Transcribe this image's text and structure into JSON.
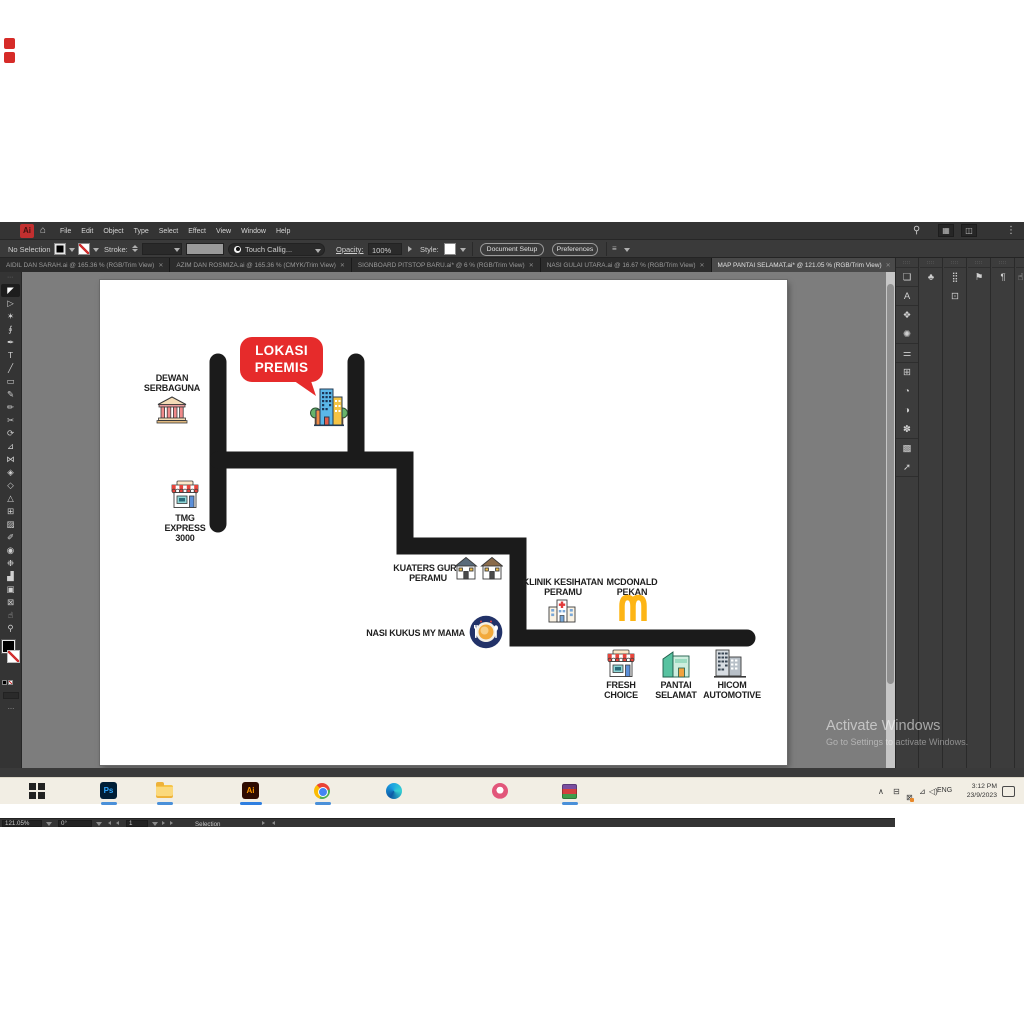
{
  "colors": {
    "accent_red": "#e62b2b",
    "road_black": "#1b1b1b",
    "pasteboard_gray": "#7d7d7d",
    "ui_dark": "#3a3a3a",
    "taskbar_beige": "#f2eee4",
    "taskbar_underline_blue": "#4a90d9",
    "mcdonald_yellow": "#fdb515"
  },
  "ui": {
    "close_glyph": "✕",
    "dock_grip": "∷∷",
    "tools_grip": "⋯",
    "ellipsis": "…"
  },
  "menubar": {
    "logo": "Ai",
    "home_icon": "⌂",
    "menus": [
      "File",
      "Edit",
      "Object",
      "Type",
      "Select",
      "Effect",
      "View",
      "Window",
      "Help"
    ],
    "right_icons": [
      {
        "name": "search",
        "glyph": "⚲"
      },
      {
        "name": "workspace-switcher",
        "glyph": "▦"
      },
      {
        "name": "arrange-documents",
        "glyph": "◫"
      },
      {
        "name": "more-options",
        "glyph": "⋮"
      }
    ]
  },
  "options_bar": {
    "no_selection": "No Selection",
    "stroke_label": "Stroke:",
    "brush_name": "Touch Callig...",
    "opacity_label": "Opacity:",
    "opacity_value": "100%",
    "style_label": "Style:",
    "document_setup": "Document Setup",
    "preferences": "Preferences",
    "align_glyph": "≡"
  },
  "tabs": [
    {
      "title": "AIDIL DAN SARAH.ai @ 165.36 % (RGB/Trim View)",
      "active": false
    },
    {
      "title": "AZIM DAN ROSMIZA.ai @ 165.36 % (CMYK/Trim View)",
      "active": false
    },
    {
      "title": "SIGNBOARD PITSTOP BARU.ai* @ 6 % (RGB/Trim View)",
      "active": false
    },
    {
      "title": "NASI GULAI UTARA.ai @ 16.67 % (RGB/Trim View)",
      "active": false
    },
    {
      "title": "MAP PANTAI SELAMAT.ai* @ 121.05 % (RGB/Trim View)",
      "active": true
    }
  ],
  "tools": [
    {
      "name": "selection",
      "glyph": "◤"
    },
    {
      "name": "direct-selection",
      "glyph": "▷"
    },
    {
      "name": "magic-wand",
      "glyph": "✶"
    },
    {
      "name": "lasso",
      "glyph": "∮"
    },
    {
      "name": "pen",
      "glyph": "✒"
    },
    {
      "name": "type",
      "glyph": "T"
    },
    {
      "name": "line-segment",
      "glyph": "╱"
    },
    {
      "name": "rectangle",
      "glyph": "▭"
    },
    {
      "name": "paintbrush",
      "glyph": "✎"
    },
    {
      "name": "pencil",
      "glyph": "✏"
    },
    {
      "name": "scissors",
      "glyph": "✂"
    },
    {
      "name": "rotate",
      "glyph": "⟳"
    },
    {
      "name": "scale",
      "glyph": "⊿"
    },
    {
      "name": "width",
      "glyph": "⋈"
    },
    {
      "name": "free-transform",
      "glyph": "◈"
    },
    {
      "name": "shape-builder",
      "glyph": "◇"
    },
    {
      "name": "perspective-grid",
      "glyph": "△"
    },
    {
      "name": "mesh",
      "glyph": "⊞"
    },
    {
      "name": "gradient",
      "glyph": "▨"
    },
    {
      "name": "eyedropper",
      "glyph": "✐"
    },
    {
      "name": "blend",
      "glyph": "◉"
    },
    {
      "name": "symbol-sprayer",
      "glyph": "❉"
    },
    {
      "name": "column-graph",
      "glyph": "▟"
    },
    {
      "name": "artboard",
      "glyph": "▣"
    },
    {
      "name": "slice",
      "glyph": "⊠"
    },
    {
      "name": "hand",
      "glyph": "☝"
    },
    {
      "name": "zoom",
      "glyph": "⚲"
    }
  ],
  "map": {
    "bubble": {
      "line1": "LOKASI",
      "line2": "PREMIS"
    },
    "dewan": {
      "line1": "DEWAN",
      "line2": "SERBAGUNA"
    },
    "tmg": {
      "line1": "TMG",
      "line2": "EXPRESS",
      "line3": "3000"
    },
    "kuaters": {
      "line1": "KUATERS GURU",
      "line2": "PERAMU"
    },
    "klinik": {
      "line1": "KLINIK KESIHATAN",
      "line2": "PERAMU"
    },
    "mcdonald": {
      "line1": "MCDONALD",
      "line2": "PEKAN"
    },
    "nasi": {
      "line1": "NASI KUKUS MY MAMA"
    },
    "fresh": {
      "line1": "FRESH",
      "line2": "CHOICE"
    },
    "pantai": {
      "line1": "PANTAI",
      "line2": "SELAMAT"
    },
    "hicom": {
      "line1": "HICOM",
      "line2": "AUTOMOTIVE"
    }
  },
  "right_dock": {
    "col1": [
      {
        "name": "artboards-panel",
        "glyph": "❏"
      },
      {
        "name": "character-panel",
        "glyph": "A"
      },
      {
        "name": "layers-panel",
        "glyph": "❖"
      },
      {
        "name": "color-panel",
        "glyph": "✺"
      },
      {
        "name": "properties-panel",
        "glyph": "⚌"
      },
      {
        "name": "libraries-panel",
        "glyph": "⊞"
      },
      {
        "name": "appearance-panel",
        "glyph": "◔"
      },
      {
        "name": "transparency-panel",
        "glyph": "◑"
      },
      {
        "name": "pattern-panel",
        "glyph": "✽"
      },
      {
        "name": "gradient-panel",
        "glyph": "▩"
      },
      {
        "name": "export-panel",
        "glyph": "➚"
      }
    ],
    "col2": [
      {
        "name": "symbols-panel",
        "glyph": "♣"
      }
    ],
    "col3": [
      {
        "name": "transform-panel",
        "glyph": "⣿"
      },
      {
        "name": "pathfinder-panel",
        "glyph": "⊡"
      }
    ],
    "col4": [
      {
        "name": "stroke-panel",
        "glyph": "⚑"
      }
    ],
    "col5": [
      {
        "name": "paragraph-panel",
        "glyph": "¶"
      }
    ],
    "col6": [
      {
        "name": "quick-actions-panel",
        "glyph": "☝"
      }
    ]
  },
  "status_bar": {
    "zoom": "121.05%",
    "rotation": "0°",
    "artboard_number": "1",
    "hint": "Selection"
  },
  "watermark": {
    "line1": "Activate Windows",
    "line2": "Go to Settings to activate Windows."
  },
  "taskbar": {
    "photoshop_label": "Ps",
    "illustrator_label": "Ai",
    "tray": {
      "chevron": "∧",
      "icon1": "⊟",
      "icon2": "⊠",
      "network": "⊿",
      "volume": "◁)",
      "lang": "ENG",
      "time": "3:12 PM",
      "date": "23/9/2023"
    }
  }
}
